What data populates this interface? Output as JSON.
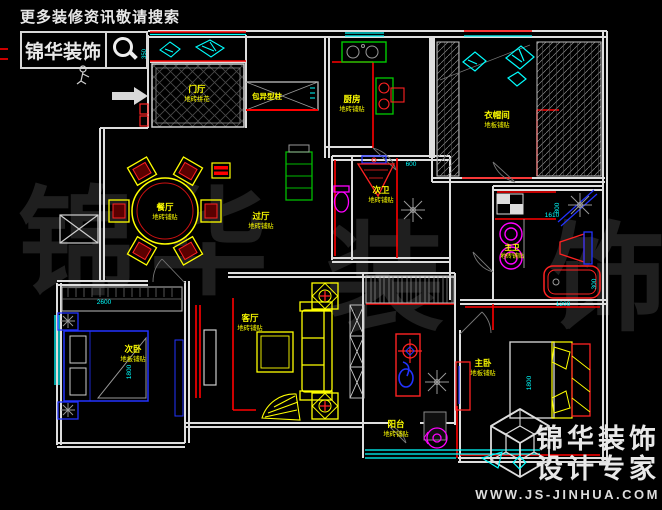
{
  "header": {
    "tagline": "更多装修资讯敬请搜索",
    "brand": "锦华装饰",
    "search_icon": "magnifier"
  },
  "watermark": {
    "chars": [
      "锦",
      "华",
      "装",
      "饰"
    ]
  },
  "footer": {
    "brand": "锦华装饰",
    "slogan": "设计专家",
    "website": "WWW.JS-JINHUA.COM",
    "logo": "wireframe-cube"
  },
  "notes": {
    "column": "包异型柱"
  },
  "rooms": {
    "entry": {
      "name": "门厅",
      "finish": "地砖拼花"
    },
    "dining": {
      "name": "餐厅",
      "finish": "地砖铺贴"
    },
    "hall": {
      "name": "过厅",
      "finish": "地砖铺贴"
    },
    "kitchen": {
      "name": "厨房",
      "finish": "地砖铺贴"
    },
    "cloak": {
      "name": "衣帽间",
      "finish": "地板铺贴"
    },
    "bath2": {
      "name": "次卫",
      "finish": "地砖铺贴"
    },
    "bath1": {
      "name": "主卫",
      "finish": "地砖铺贴"
    },
    "bed2": {
      "name": "次卧",
      "finish": "地板铺贴"
    },
    "living": {
      "name": "客厅",
      "finish": "地砖铺贴"
    },
    "master": {
      "name": "主卧",
      "finish": "地板铺贴"
    },
    "balcony": {
      "name": "阳台",
      "finish": "地砖铺贴"
    }
  },
  "dimensions": {
    "closet": "350",
    "wardrobe": "2600",
    "bed2": "1800",
    "bath2door": "600",
    "shower": "800",
    "vanity": "1610",
    "bed1": "1800",
    "tub": "1200",
    "tubw": "300"
  },
  "colors": {
    "wall": "#dedede",
    "accent": "#ff0000",
    "window": "#00ffff",
    "furniture": "#ffff00",
    "bed_blue": "#2233ff",
    "fixture": "#ff00ff",
    "cabinet_green": "#00bb00",
    "label": "#ffff00",
    "dimension": "#00ffff"
  }
}
